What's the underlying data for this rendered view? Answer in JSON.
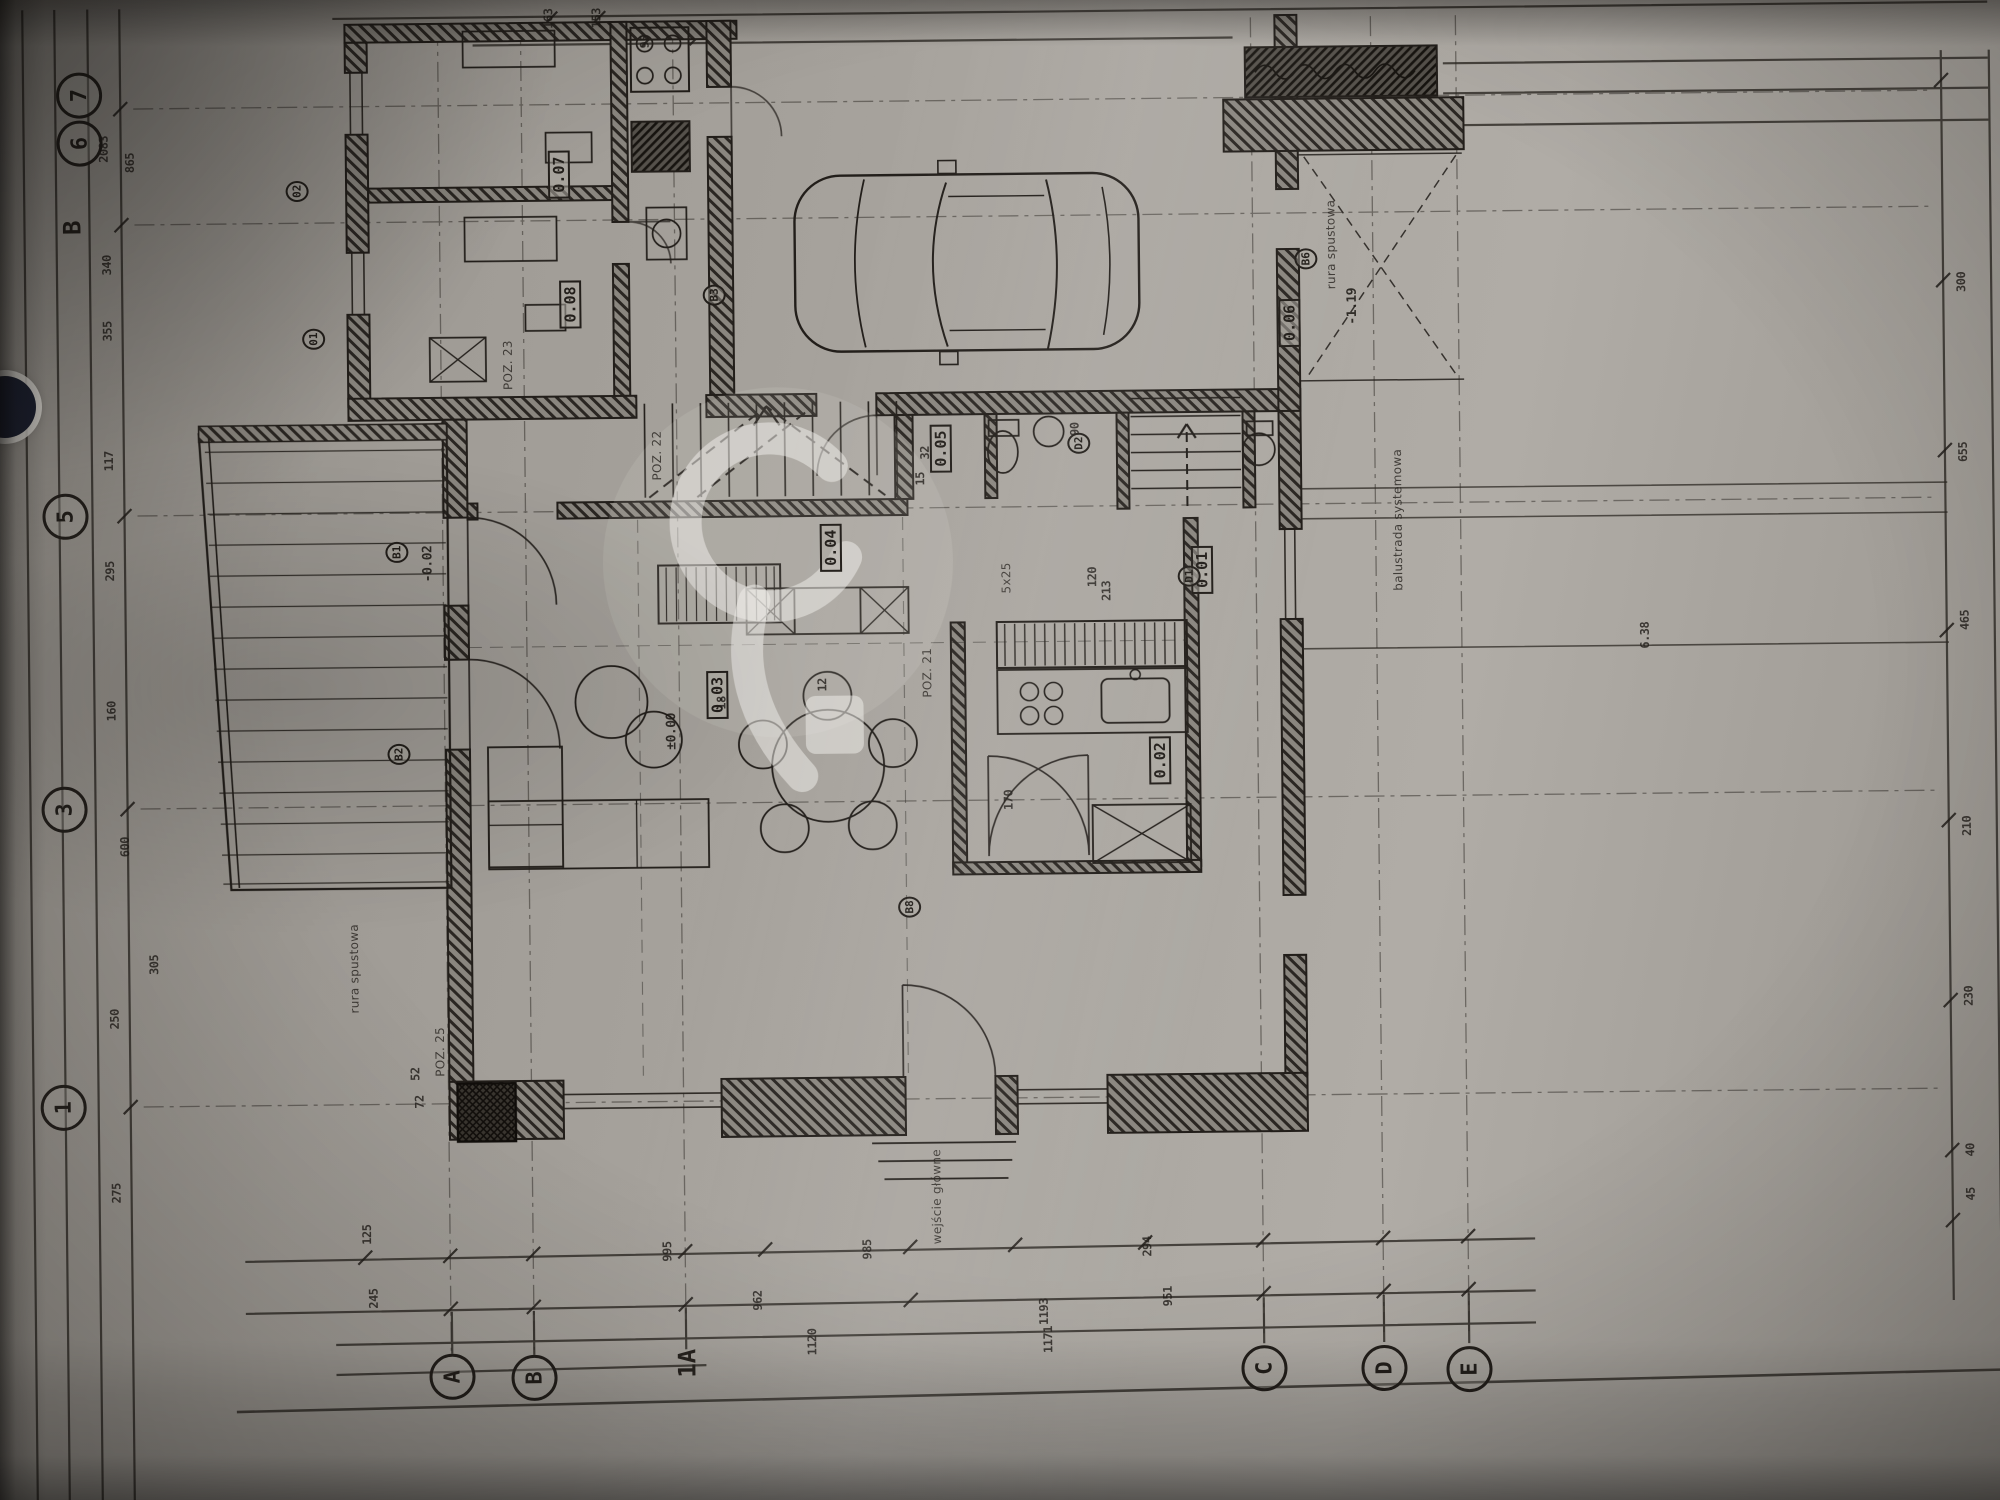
{
  "meta": {
    "document_kind": "architectural floor plan photograph",
    "sheet_content": "ground floor plan with garage, living room, kitchen, terrace and stairs",
    "orientation_note": "drawing photographed rotated 90 degrees, all text reads bottom-to-top"
  },
  "photo": {
    "paper_color": "#a8a49e",
    "ink_color": "#2c2823",
    "shadow_color": "#5d5955",
    "watermark_color": "#f4f2ee",
    "watermark_shape": "p-dot-logo"
  },
  "label_groups": [
    {
      "name": "axis-bubble",
      "class": "bubble",
      "items": [
        {
          "text": "7",
          "x": 86,
          "y": 86
        },
        {
          "text": "6",
          "x": 86,
          "y": 134
        },
        {
          "text": "5",
          "x": 68,
          "y": 507
        },
        {
          "text": "3",
          "x": 64,
          "y": 800
        },
        {
          "text": "1",
          "x": 60,
          "y": 1098
        },
        {
          "text": "A",
          "x": 446,
          "y": 1371
        },
        {
          "text": "B",
          "x": 528,
          "y": 1373
        },
        {
          "text": "C",
          "x": 1258,
          "y": 1371
        },
        {
          "text": "D",
          "x": 1378,
          "y": 1372
        },
        {
          "text": "E",
          "x": 1463,
          "y": 1374
        }
      ]
    },
    {
      "name": "axis-section-mark",
      "class": "section-label",
      "items": [
        {
          "text": "B",
          "x": 78,
          "y": 218
        },
        {
          "text": "1A",
          "x": 681,
          "y": 1360
        }
      ]
    },
    {
      "name": "room-number-tag",
      "class": "tag",
      "items": [
        {
          "text": "0.07",
          "x": 565,
          "y": 170
        },
        {
          "text": "0.08",
          "x": 575,
          "y": 300
        },
        {
          "text": "0.06",
          "x": 1294,
          "y": 326
        },
        {
          "text": "0.05",
          "x": 944,
          "y": 448
        },
        {
          "text": "0.04",
          "x": 833,
          "y": 546
        },
        {
          "text": "0.03",
          "x": 718,
          "y": 692
        },
        {
          "text": "0.02",
          "x": 1160,
          "y": 762
        },
        {
          "text": "0.01",
          "x": 1204,
          "y": 572
        }
      ]
    },
    {
      "name": "reference-marker",
      "class": "marker",
      "items": [
        {
          "text": "01",
          "x": 318,
          "y": 332
        },
        {
          "text": "02",
          "x": 303,
          "y": 184
        },
        {
          "text": "B1",
          "x": 399,
          "y": 546
        },
        {
          "text": "B2",
          "x": 399,
          "y": 748
        },
        {
          "text": "B3",
          "x": 719,
          "y": 292
        },
        {
          "text": "B6",
          "x": 1311,
          "y": 262
        },
        {
          "text": "B8",
          "x": 908,
          "y": 906
        },
        {
          "text": "D1",
          "x": 1191,
          "y": 578
        },
        {
          "text": "D2",
          "x": 1082,
          "y": 444
        }
      ]
    },
    {
      "name": "level-mark",
      "class": "plan-label dim level",
      "items": [
        {
          "text": "±0.00",
          "x": 672,
          "y": 728
        },
        {
          "text": "-0.02",
          "x": 430,
          "y": 558
        },
        {
          "text": "-1.19",
          "x": 1357,
          "y": 310
        }
      ]
    },
    {
      "name": "annotation",
      "class": "note",
      "items": [
        {
          "text": "wejście główne",
          "x": 932,
          "y": 1196
        },
        {
          "text": "balustrada systemowa",
          "x": 1400,
          "y": 524
        },
        {
          "text": "rura spustowa",
          "x": 1336,
          "y": 248
        },
        {
          "text": "rura spustowa",
          "x": 352,
          "y": 962
        },
        {
          "text": "POZ. 21",
          "x": 928,
          "y": 672
        },
        {
          "text": "POZ. 22",
          "x": 660,
          "y": 452
        },
        {
          "text": "POZ. 23",
          "x": 512,
          "y": 360
        },
        {
          "text": "POZ. 25",
          "x": 437,
          "y": 1046
        },
        {
          "text": "5x25",
          "x": 1008,
          "y": 578
        }
      ]
    },
    {
      "name": "dimension",
      "class": "dim",
      "items": [
        {
          "text": "2083",
          "x": 110,
          "y": 140
        },
        {
          "text": "865",
          "x": 136,
          "y": 154
        },
        {
          "text": "340",
          "x": 112,
          "y": 256
        },
        {
          "text": "355",
          "x": 112,
          "y": 322
        },
        {
          "text": "117",
          "x": 112,
          "y": 452
        },
        {
          "text": "295",
          "x": 112,
          "y": 562
        },
        {
          "text": "160",
          "x": 112,
          "y": 702
        },
        {
          "text": "600",
          "x": 124,
          "y": 838
        },
        {
          "text": "305",
          "x": 152,
          "y": 956
        },
        {
          "text": "250",
          "x": 112,
          "y": 1010
        },
        {
          "text": "275",
          "x": 112,
          "y": 1184
        },
        {
          "text": "163",
          "x": 556,
          "y": 14
        },
        {
          "text": "153",
          "x": 604,
          "y": 14
        },
        {
          "text": "95",
          "x": 652,
          "y": 38
        },
        {
          "text": "300",
          "x": 1966,
          "y": 292
        },
        {
          "text": "655",
          "x": 1966,
          "y": 462
        },
        {
          "text": "465",
          "x": 1966,
          "y": 630
        },
        {
          "text": "210",
          "x": 1966,
          "y": 836
        },
        {
          "text": "230",
          "x": 1966,
          "y": 1006
        },
        {
          "text": "40",
          "x": 1966,
          "y": 1160
        },
        {
          "text": "45",
          "x": 1966,
          "y": 1204
        },
        {
          "text": "6.38",
          "x": 1646,
          "y": 642
        },
        {
          "text": "125",
          "x": 362,
          "y": 1228
        },
        {
          "text": "245",
          "x": 368,
          "y": 1292
        },
        {
          "text": "52",
          "x": 412,
          "y": 1068
        },
        {
          "text": "72",
          "x": 416,
          "y": 1096
        },
        {
          "text": "995",
          "x": 662,
          "y": 1248
        },
        {
          "text": "985",
          "x": 862,
          "y": 1248
        },
        {
          "text": "294",
          "x": 1142,
          "y": 1248
        },
        {
          "text": "962",
          "x": 752,
          "y": 1298
        },
        {
          "text": "951",
          "x": 1162,
          "y": 1298
        },
        {
          "text": "1193",
          "x": 1038,
          "y": 1312
        },
        {
          "text": "1171",
          "x": 1042,
          "y": 1340
        },
        {
          "text": "1120",
          "x": 806,
          "y": 1340
        },
        {
          "text": "120",
          "x": 1094,
          "y": 578
        },
        {
          "text": "213",
          "x": 1108,
          "y": 592
        },
        {
          "text": "32",
          "x": 928,
          "y": 452
        },
        {
          "text": "15",
          "x": 923,
          "y": 478
        },
        {
          "text": "18",
          "x": 722,
          "y": 700
        },
        {
          "text": "12",
          "x": 823,
          "y": 683
        },
        {
          "text": "170",
          "x": 1008,
          "y": 800
        },
        {
          "text": "90",
          "x": 1078,
          "y": 430
        }
      ]
    }
  ]
}
